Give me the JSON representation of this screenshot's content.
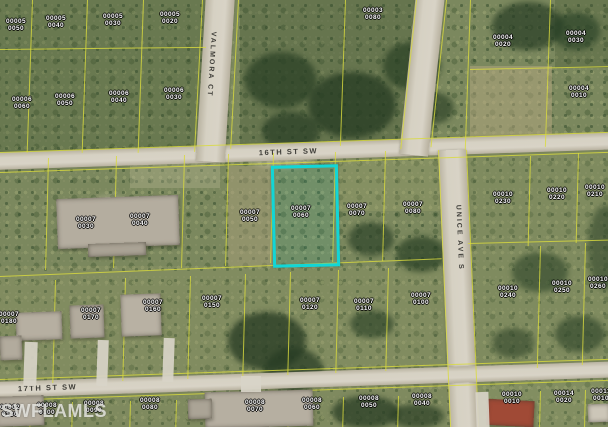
{
  "map": {
    "watermark": "SWFLAMLS",
    "highlight_color": "#12D6D6",
    "parcel_line_color": "#D9DA3E"
  },
  "streets": [
    {
      "name": "16TH ST SW",
      "orientation": "horizontal"
    },
    {
      "name": "VALMORA CT",
      "orientation": "vertical"
    },
    {
      "name": "UNICE AVE S",
      "orientation": "vertical"
    },
    {
      "name": "17TH ST SW",
      "orientation": "horizontal"
    }
  ],
  "highlighted_parcel": {
    "block": "00007",
    "lot": "0060"
  },
  "parcels": [
    {
      "block": "00005",
      "lot": "0050",
      "x": 16,
      "y": 25,
      "highlighted": false
    },
    {
      "block": "00005",
      "lot": "0040",
      "x": 56,
      "y": 22,
      "highlighted": false
    },
    {
      "block": "00005",
      "lot": "0030",
      "x": 113,
      "y": 20,
      "highlighted": false
    },
    {
      "block": "00005",
      "lot": "0020",
      "x": 170,
      "y": 18,
      "highlighted": false
    },
    {
      "block": "00006",
      "lot": "0060",
      "x": 22,
      "y": 103,
      "highlighted": false
    },
    {
      "block": "00006",
      "lot": "0050",
      "x": 65,
      "y": 100,
      "highlighted": false
    },
    {
      "block": "00006",
      "lot": "0040",
      "x": 119,
      "y": 97,
      "highlighted": false
    },
    {
      "block": "00006",
      "lot": "0030",
      "x": 174,
      "y": 94,
      "highlighted": false
    },
    {
      "block": "00003",
      "lot": "0080",
      "x": 373,
      "y": 14,
      "highlighted": false
    },
    {
      "block": "00004",
      "lot": "0020",
      "x": 503,
      "y": 41,
      "highlighted": false
    },
    {
      "block": "00004",
      "lot": "0030",
      "x": 576,
      "y": 37,
      "highlighted": false
    },
    {
      "block": "00004",
      "lot": "0010",
      "x": 579,
      "y": 92,
      "highlighted": false
    },
    {
      "block": "00007",
      "lot": "0030",
      "x": 86,
      "y": 223,
      "highlighted": false
    },
    {
      "block": "00007",
      "lot": "0040",
      "x": 140,
      "y": 220,
      "highlighted": false
    },
    {
      "block": "00007",
      "lot": "0050",
      "x": 250,
      "y": 216,
      "highlighted": false
    },
    {
      "block": "00007",
      "lot": "0060",
      "x": 301,
      "y": 212,
      "highlighted": true
    },
    {
      "block": "00007",
      "lot": "0070",
      "x": 357,
      "y": 210,
      "highlighted": false
    },
    {
      "block": "00007",
      "lot": "0080",
      "x": 413,
      "y": 208,
      "highlighted": false
    },
    {
      "block": "00010",
      "lot": "0230",
      "x": 503,
      "y": 198,
      "highlighted": false
    },
    {
      "block": "00010",
      "lot": "0220",
      "x": 557,
      "y": 194,
      "highlighted": false
    },
    {
      "block": "00010",
      "lot": "0210",
      "x": 595,
      "y": 191,
      "highlighted": false
    },
    {
      "block": "00010",
      "lot": "0240",
      "x": 508,
      "y": 292,
      "highlighted": false
    },
    {
      "block": "00010",
      "lot": "0250",
      "x": 562,
      "y": 287,
      "highlighted": false
    },
    {
      "block": "00010",
      "lot": "0260",
      "x": 598,
      "y": 283,
      "highlighted": false
    },
    {
      "block": "00007",
      "lot": "0180",
      "x": 9,
      "y": 318,
      "highlighted": false
    },
    {
      "block": "00007",
      "lot": "0170",
      "x": 91,
      "y": 314,
      "highlighted": false
    },
    {
      "block": "00007",
      "lot": "0160",
      "x": 153,
      "y": 306,
      "highlighted": false
    },
    {
      "block": "00007",
      "lot": "0150",
      "x": 212,
      "y": 302,
      "highlighted": false
    },
    {
      "block": "00007",
      "lot": "0120",
      "x": 310,
      "y": 304,
      "highlighted": false
    },
    {
      "block": "00007",
      "lot": "0110",
      "x": 364,
      "y": 305,
      "highlighted": false
    },
    {
      "block": "00007",
      "lot": "0100",
      "x": 421,
      "y": 299,
      "highlighted": false
    },
    {
      "block": "00002",
      "lot": "0130",
      "x": 10,
      "y": 411,
      "highlighted": false
    },
    {
      "block": "00008",
      "lot": "0100",
      "x": 47,
      "y": 409,
      "highlighted": false
    },
    {
      "block": "00008",
      "lot": "0090",
      "x": 94,
      "y": 407,
      "highlighted": false
    },
    {
      "block": "00008",
      "lot": "0080",
      "x": 150,
      "y": 404,
      "highlighted": false
    },
    {
      "block": "00008",
      "lot": "0070",
      "x": 255,
      "y": 406,
      "highlighted": false
    },
    {
      "block": "00008",
      "lot": "0060",
      "x": 312,
      "y": 404,
      "highlighted": false
    },
    {
      "block": "00008",
      "lot": "0050",
      "x": 369,
      "y": 402,
      "highlighted": false
    },
    {
      "block": "00008",
      "lot": "0040",
      "x": 422,
      "y": 400,
      "highlighted": false
    },
    {
      "block": "00010",
      "lot": "0010",
      "x": 512,
      "y": 398,
      "highlighted": false
    },
    {
      "block": "00014",
      "lot": "0020",
      "x": 564,
      "y": 397,
      "highlighted": false
    },
    {
      "block": "00011",
      "lot": "0010",
      "x": 601,
      "y": 395,
      "highlighted": false
    }
  ]
}
